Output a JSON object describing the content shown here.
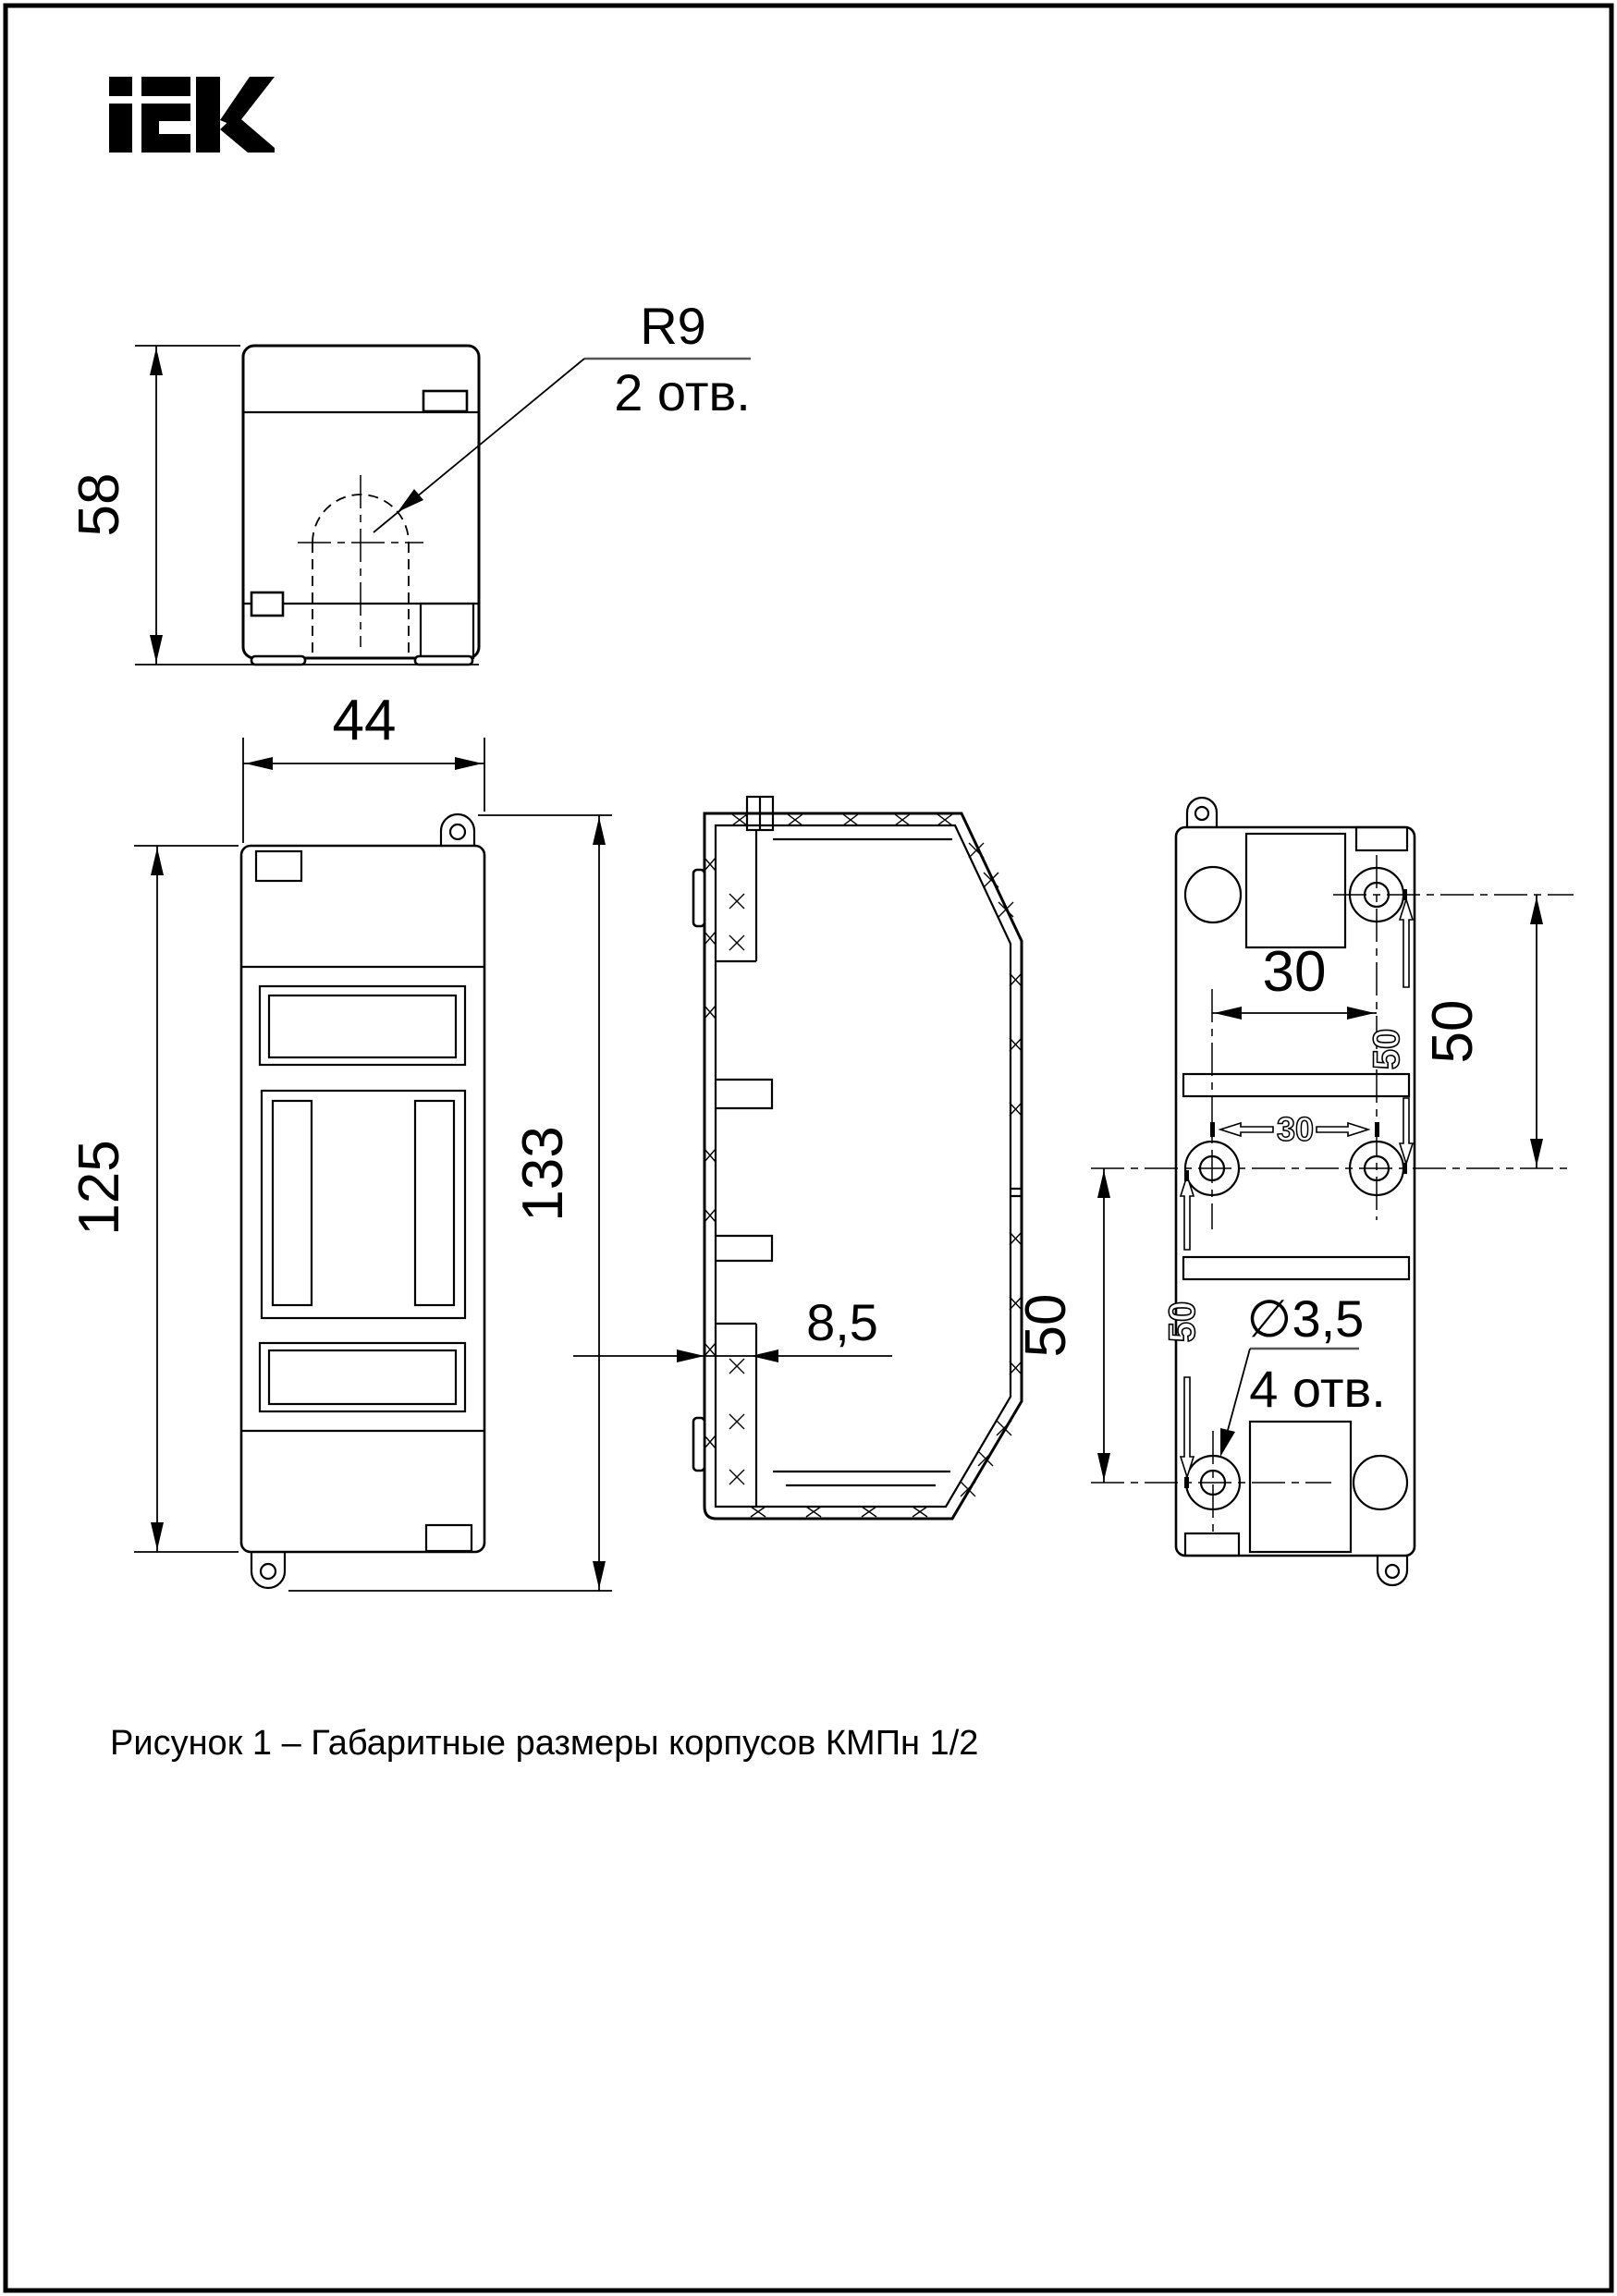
{
  "logo": {
    "label": "iEK"
  },
  "caption": "Рисунок 1 – Габаритные размеры корпусов КМПн 1/2",
  "top_view": {
    "height": "58",
    "note_radius": "R9",
    "note_holes": "2 отв."
  },
  "front_view": {
    "width": "44",
    "body_height": "125",
    "overall_height": "133"
  },
  "side_view": {
    "wall_thickness": "8,5"
  },
  "back_view": {
    "hole_spacing_horizontal": "30",
    "hole_spacing_vertical_right": "50",
    "hole_spacing_vertical_left": "50",
    "molded_mark_30": "30",
    "molded_mark_50_upper": "50",
    "molded_mark_50_lower": "50",
    "note_diameter": "∅3,5",
    "note_holes": "4 отв."
  }
}
